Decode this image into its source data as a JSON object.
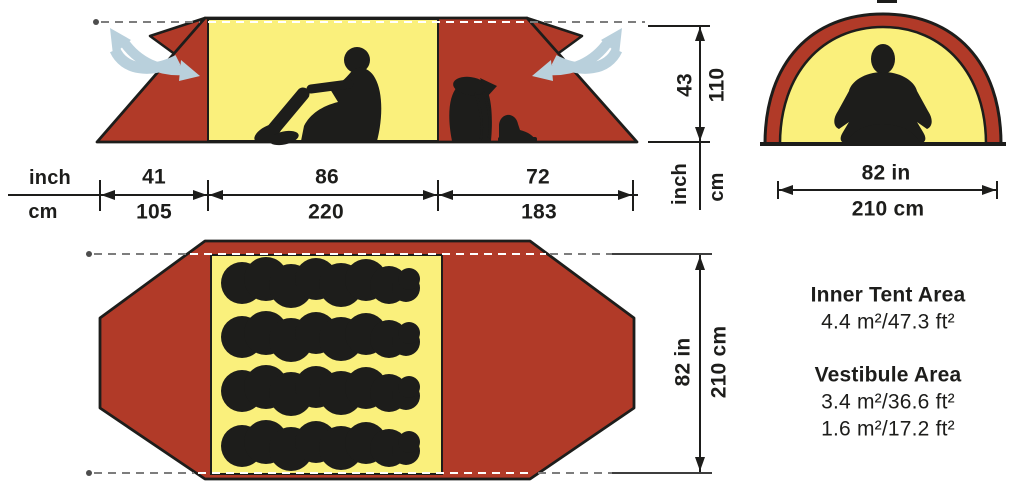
{
  "units": {
    "inch": "inch",
    "cm": "cm"
  },
  "side_view": {
    "widths": [
      {
        "inch": "41",
        "cm": "105"
      },
      {
        "inch": "86",
        "cm": "220"
      },
      {
        "inch": "72",
        "cm": "183"
      }
    ],
    "height": {
      "inch": "43",
      "cm": "110"
    }
  },
  "front_view": {
    "width_inch": "82 in",
    "width_cm": "210 cm"
  },
  "floor_plan": {
    "depth_inch": "82 in",
    "depth_cm": "210 cm"
  },
  "areas": {
    "inner_tent": {
      "title": "Inner Tent Area",
      "value": "4.4 m²/47.3 ft²"
    },
    "vestibule": {
      "title": "Vestibule Area",
      "value1": "3.4 m²/36.6 ft²",
      "value2": "1.6 m²/17.2 ft²"
    }
  },
  "colors": {
    "tent_red": "#b13a28",
    "inner_yellow": "#faf07c",
    "vent_blue": "#b9d0dc",
    "silhouette_black": "#1d1d1b",
    "dash_gray": "#7d7d7d"
  }
}
